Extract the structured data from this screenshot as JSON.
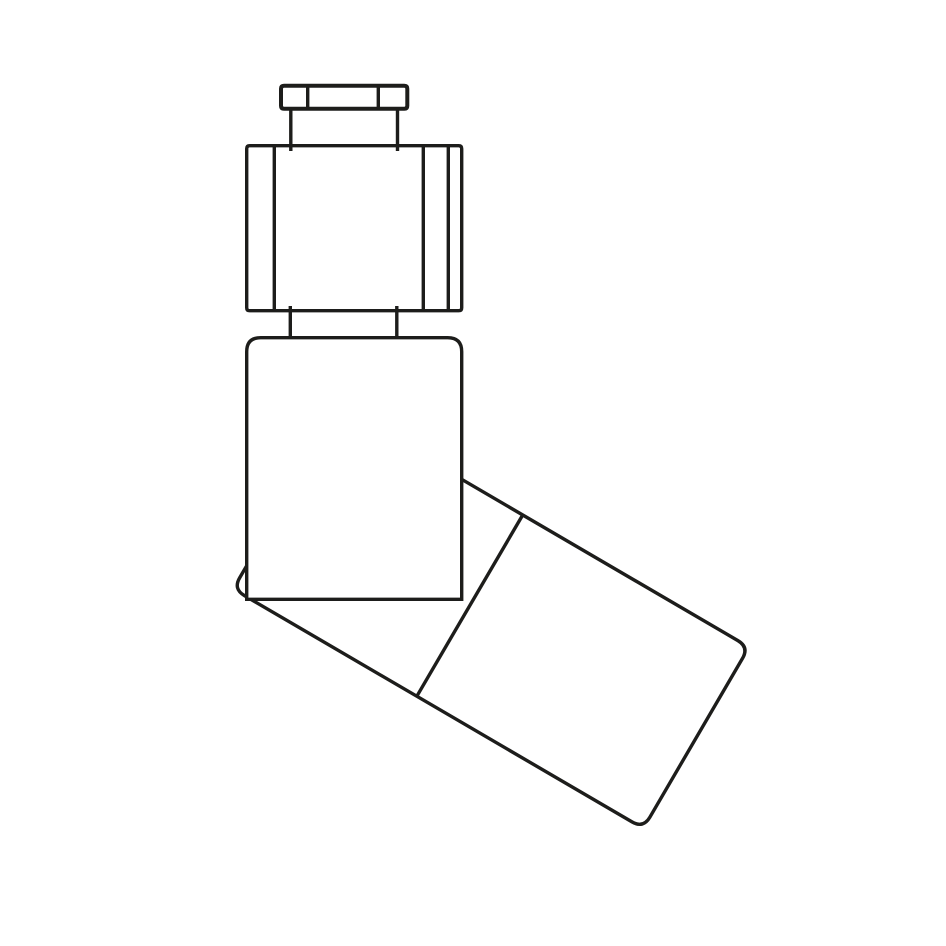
{
  "canvas": {
    "width": 946,
    "height": 946,
    "background_color": "#ffffff"
  },
  "style": {
    "line_color": "#1d1d1b",
    "line_width": 3.4,
    "cap_line_width": 4,
    "fill_color": "#ffffff"
  },
  "drawing": {
    "type": "technical-line-drawing",
    "subject": "angled fitting side view",
    "components": [
      {
        "id": "stem-cap",
        "label": "stem cap with facet lines"
      },
      {
        "id": "upper-neck",
        "label": "upper neck"
      },
      {
        "id": "hex-nut",
        "label": "hex nut section with facet lines"
      },
      {
        "id": "lower-neck",
        "label": "lower neck"
      },
      {
        "id": "main-body",
        "label": "upright body with rounded shoulders"
      },
      {
        "id": "angled-port",
        "label": "angled port rotated about 30 degrees"
      },
      {
        "id": "port-joint-line",
        "label": "perpendicular joint line across angled port"
      }
    ],
    "paths": {
      "angled_port_outline": "M 350.2 414.2 L 737.9 640.6 Q 749.1 647.2 742.5 658.4 L 649.8 817.3 Q 643.2 828.5 632 821.9 L 244.3 595.5 Q 233.1 588.9 239.7 577.7 L 332.4 418.8 Q 339 407.6 350.2 414.2 Z",
      "port_joint_line": "M 522.7 515 L 416.8 696.3",
      "main_body_outline": "M 246.7 599.3 L 246.7 351.7 Q 246.7 337.7 260.7 337.7 L 447.7 337.7 Q 461.7 337.7 461.7 351.7 L 461.7 599.3 Z",
      "hex_nut_outline": "M 249.7 145.7 L 458.7 145.7 Q 461.7 145.7 461.7 148.7 L 461.7 307.7 Q 461.7 310.7 458.7 310.7 L 249.7 310.7 Q 246.7 310.7 246.7 307.7 L 246.7 148.7 Q 246.7 145.7 249.7 145.7 Z",
      "hex_nut_facets": "M 274.3 145.7 L 274.3 310.7 M 423.3 145.7 L 423.3 310.7 M 448.3 145.7 L 448.3 310.7",
      "lower_neck": "M 290.3 306 L 290.3 339 M 396.8 306 L 396.8 339",
      "upper_neck": "M 290.8 109 L 290.8 151 M 397.5 109 L 397.5 151",
      "stem_cap_outline": "M 284 85.7 L 404.3 85.7 Q 407.3 85.7 407.3 88.7 L 407.3 105.7 Q 407.3 108.7 404.3 108.7 L 284 108.7 Q 281 108.7 281 105.7 L 281 88.7 Q 281 85.7 284 85.7 Z",
      "stem_cap_facets": "M 307.7 85.7 L 307.7 108.7 M 378.3 85.7 L 378.3 108.7"
    }
  }
}
